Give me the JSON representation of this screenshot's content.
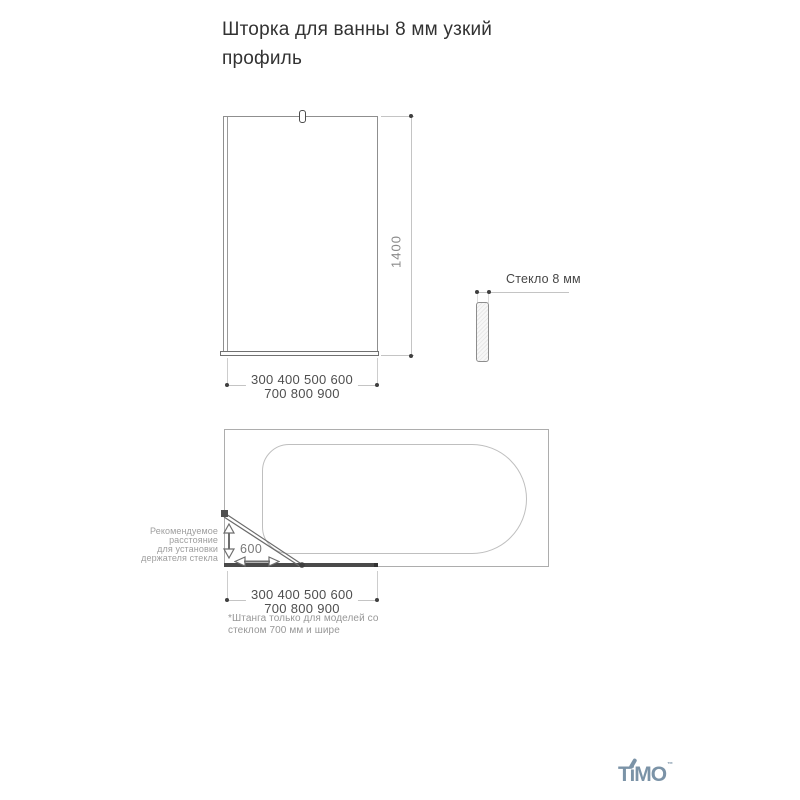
{
  "title": "Шторка для ванны 8 мм узкий профиль",
  "front_view": {
    "height_label": "1400",
    "widths_line1": "300 400 500 600",
    "widths_line2": "700 800 900"
  },
  "side_view": {
    "glass_label": "Стекло 8 мм"
  },
  "top_view": {
    "distance_label": "600",
    "note_lines": [
      "Рекомендуемое",
      "расстояние",
      "для установки",
      "держателя стекла"
    ],
    "widths_line1": "300 400 500 600",
    "widths_line2": "700 800 900",
    "footnote_line1": "*Штанга только для моделей со",
    "footnote_line2": "стеклом 700 мм и шире"
  },
  "logo": {
    "text": "TiMO",
    "tm": "™",
    "color": "#7b93a7"
  }
}
